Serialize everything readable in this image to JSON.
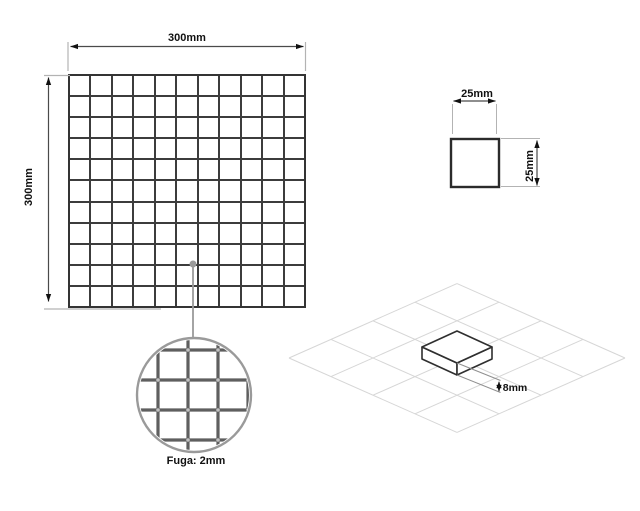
{
  "diagram": {
    "title_semantic": "mosaic-tile-specification-drawing",
    "background": "#ffffff",
    "line_color": "#2f2f2f",
    "dim_line_color": "#4a4a4a",
    "aux_line_color": "#b3b3b3",
    "detail_color": "#9a9a9a",
    "iso_grid_color": "#d6d6d6"
  },
  "sheet": {
    "width_label": "300mm",
    "height_label": "300mm",
    "rows": 11,
    "cols": 11
  },
  "tile": {
    "width_label": "25mm",
    "height_label": "25mm",
    "thickness_label": "8mm"
  },
  "detail": {
    "label": "Fuga: 2mm",
    "grid_lines_x": 4,
    "grid_lines_y": 4
  },
  "iso": {
    "rows": 4,
    "cols": 4
  }
}
